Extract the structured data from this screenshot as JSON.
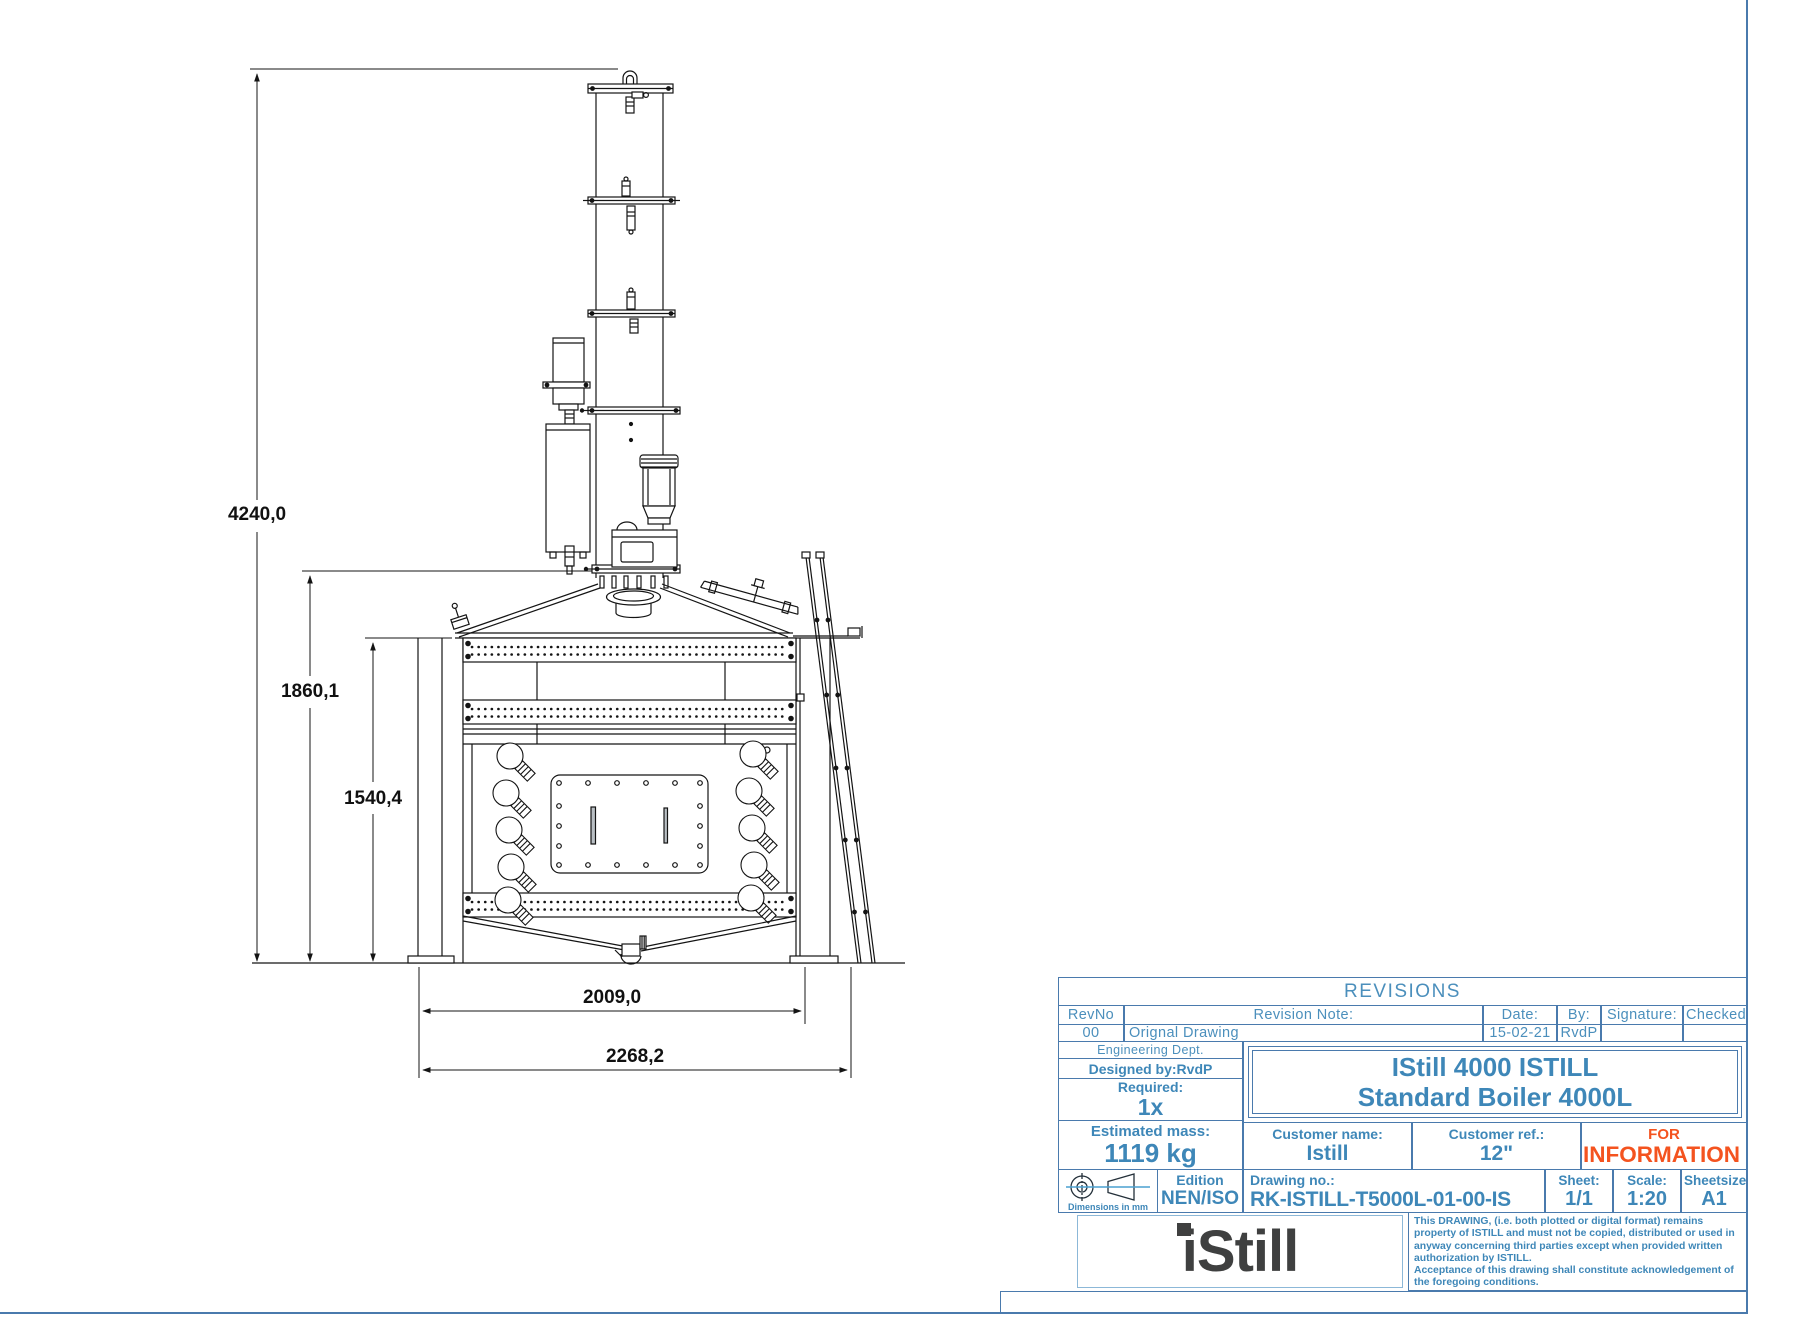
{
  "drawing": {
    "description": "front-view technical drawing of a distillation boiler with column",
    "dimensions": {
      "total_height": "4240,0",
      "column_base_height": "1860,1",
      "boiler_height": "1540,4",
      "boiler_width": "2009,0",
      "overall_width": "2268,2"
    }
  },
  "revisions": {
    "title": "REVISIONS",
    "headers": {
      "rev_no": "RevNo",
      "note": "Revision Note:",
      "date": "Date:",
      "by": "By:",
      "signature": "Signature:",
      "checked": "Checked:"
    },
    "row": {
      "rev_no": "00",
      "note": "Orignal Drawing",
      "date": "15-02-21",
      "by": "RvdP",
      "signature": "",
      "checked": ""
    }
  },
  "title_block": {
    "department": "Engineering Dept.",
    "designed_by": "Designed by:RvdP",
    "required_label": "Required:",
    "required_value": "1x",
    "mass_label": "Estimated mass:",
    "mass_value": "1119 kg",
    "symbol_note": "Dimensions in mm",
    "edition_label": "Edition",
    "edition_value": "NEN/ISO",
    "title_line1": "IStill 4000 ISTILL",
    "title_line2": "Standard Boiler 4000L",
    "customer_name_label": "Customer name:",
    "customer_name_value": "Istill",
    "customer_ref_label": "Customer ref.:",
    "customer_ref_value": "12\"",
    "stamp_line1": "FOR",
    "stamp_line2": "INFORMATION",
    "drawing_no_label": "Drawing no.:",
    "drawing_no_value": "RK-ISTILL-T5000L-01-00-IS",
    "sheet_label": "Sheet:",
    "sheet_value": "1/1",
    "scale_label": "Scale:",
    "scale_value": "1:20",
    "sheetsize_label": "Sheetsize:",
    "sheetsize_value": "A1",
    "logo_text": "iStill",
    "disclaimer_p1": "This DRAWING, (i.e. both plotted or digital format) remains property of ISTILL and must not be copied, distributed or used in anyway concerning third parties except when provided written authorization by ISTILL.",
    "disclaimer_p2": "Acceptance of this drawing shall constitute acknowledgement of the foregoing conditions."
  },
  "colors": {
    "table_line_blue": "#4a7aad",
    "text_blue": "#3e87b8",
    "cad_text_blue": "#4b8fbc",
    "stamp_orange": "#f4531f",
    "logo_dark": "#3f4040",
    "drawing_black": "#141414"
  }
}
